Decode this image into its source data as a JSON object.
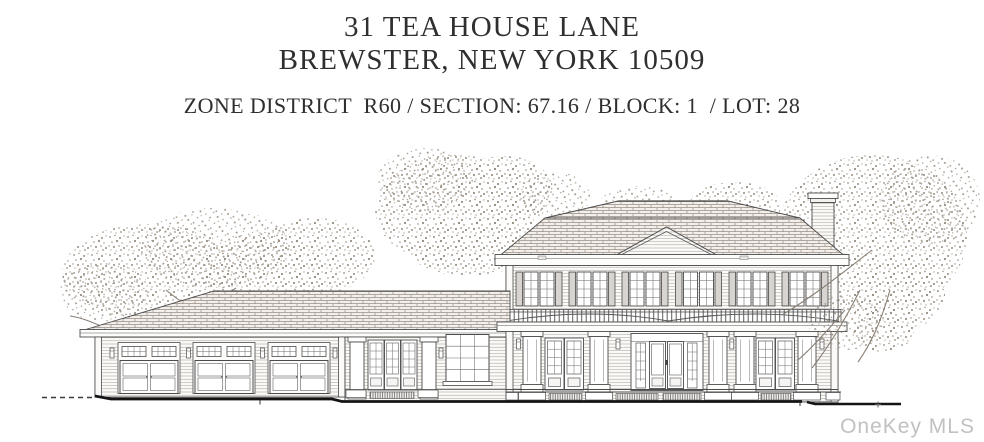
{
  "header": {
    "address_line_1": "31 TEA HOUSE LANE",
    "address_line_2": "BREWSTER, NEW YORK 10509",
    "zoning_line": "ZONE DISTRICT  R60 / SECTION: 67.16 / BLOCK: 1  / LOT: 28"
  },
  "drawing": {
    "type": "front-elevation-line-drawing",
    "features": [
      "two-story main house with two-tier hip roof and center pediment",
      "six shuttered window pairs on second floor",
      "porch-roof balustrade above covered porch",
      "paneled square porch columns with french doors",
      "center entry with double glass door and sidelights",
      "one-story connector wing with triple french door and twelve-pane window",
      "attached three-bay garage with transom windows and paneled doors",
      "chimney at right roof end",
      "sketched background trees",
      "heavy ground line with dashed grade extension at left"
    ]
  },
  "watermark": {
    "text": "OneKey MLS"
  },
  "colors": {
    "background": "#ffffff",
    "heading_text": "#2f2f2f",
    "line_art": "#4c4c4c",
    "roof_texture": "#998f84",
    "tree_stipple": "#978d80",
    "ground_line": "#141414",
    "watermark_text": "#c2c1c0"
  }
}
